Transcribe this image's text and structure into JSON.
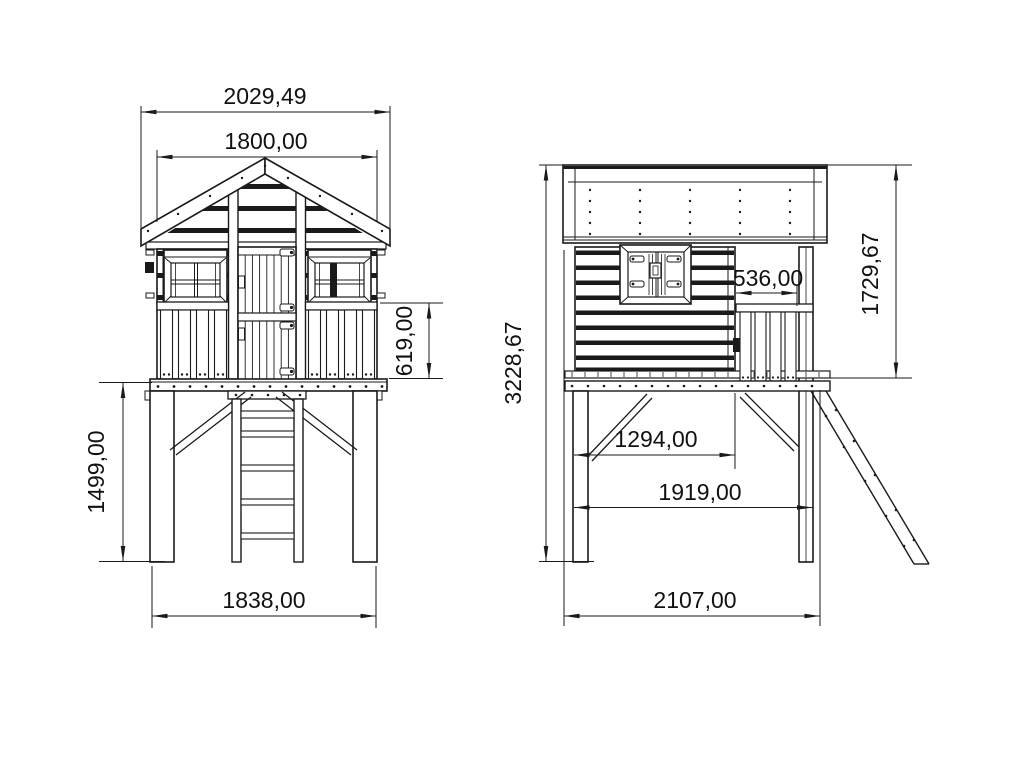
{
  "drawing": {
    "title": "Wooden stilt playhouse technical drawing",
    "unit": "mm",
    "colors": {
      "background": "#ffffff",
      "line": "#1a1a1a"
    },
    "front_view": {
      "label": "front elevation",
      "dims": {
        "roof_overhang_width": "2029,49",
        "house_width": "1800,00",
        "railing_height": "619,00",
        "leg_height": "1499,00",
        "base_width": "1838,00"
      }
    },
    "side_view": {
      "label": "side elevation",
      "dims": {
        "total_height": "3228,67",
        "house_section_height": "1729,67",
        "porch_depth": "536,00",
        "inner_span": "1294,00",
        "outer_leg_span": "1919,00",
        "total_depth": "2107,00"
      }
    }
  }
}
